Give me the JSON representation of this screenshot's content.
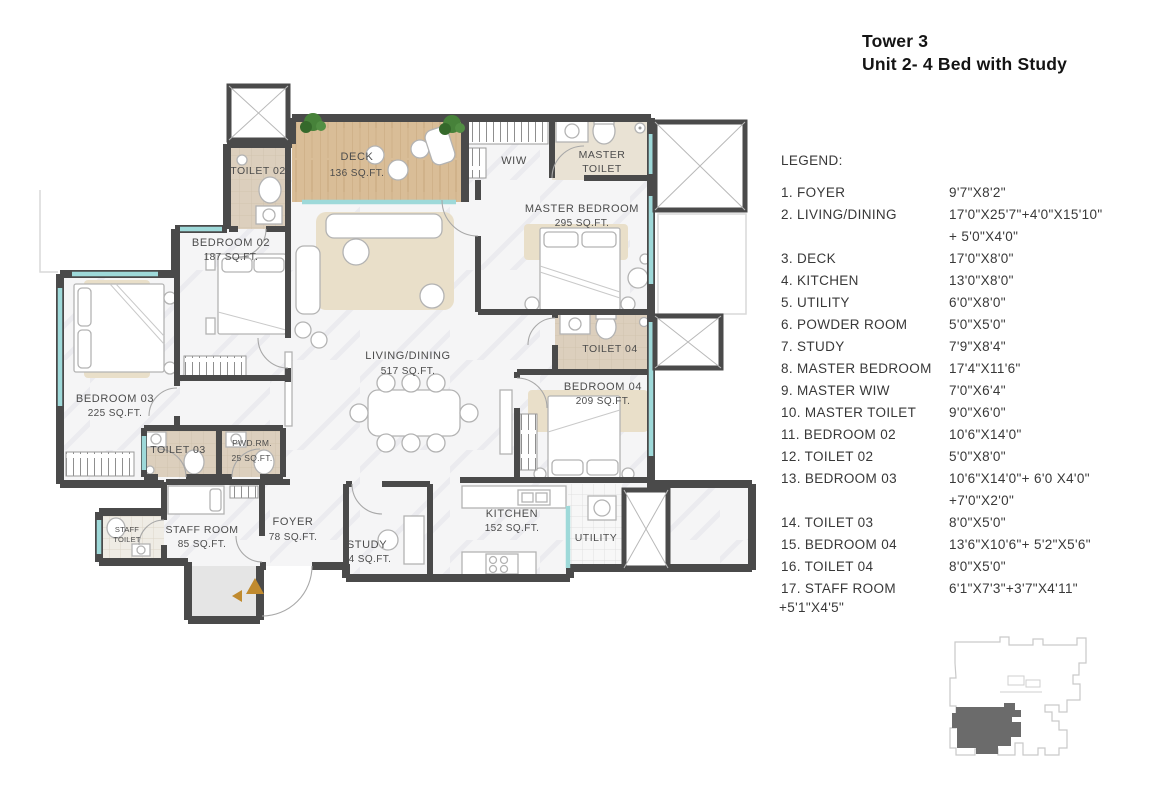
{
  "title": {
    "line1": "Tower 3",
    "line2": "Unit 2- 4 Bed with Study"
  },
  "legend": {
    "heading": "LEGEND:",
    "items": [
      {
        "label": "1. FOYER",
        "dim": "9'7\"X8'2\""
      },
      {
        "label": "2. LIVING/DINING",
        "dim": "17'0\"X25'7\"+4'0\"X15'10\"",
        "dim2": "+ 5'0\"X4'0\""
      },
      {
        "label": "3. DECK",
        "dim": "17'0\"X8'0\""
      },
      {
        "label": "4. KITCHEN",
        "dim": "13'0\"X8'0\""
      },
      {
        "label": "5. UTILITY",
        "dim": "6'0\"X8'0\""
      },
      {
        "label": "6. POWDER ROOM",
        "dim": "5'0\"X5'0\""
      },
      {
        "label": "7. STUDY",
        "dim": "7'9\"X8'4\""
      },
      {
        "label": "8. MASTER BEDROOM",
        "dim": "17'4\"X11'6\""
      },
      {
        "label": "9. MASTER WIW",
        "dim": "7'0\"X6'4\""
      },
      {
        "label": "10. MASTER TOILET",
        "dim": "9'0\"X6'0\""
      },
      {
        "label": "11. BEDROOM 02",
        "dim": "10'6\"X14'0\""
      },
      {
        "label": "12. TOILET 02",
        "dim": "5'0\"X8'0\""
      },
      {
        "label": "13. BEDROOM 03",
        "dim": "10'6\"X14'0\"+ 6'0 X4'0\"",
        "dim2": "+7'0\"X2'0\""
      },
      {
        "label": "14. TOILET 03",
        "dim": "8'0\"X5'0\""
      },
      {
        "label": "15. BEDROOM 04",
        "dim": "13'6\"X10'6\"+ 5'2\"X5'6\""
      },
      {
        "label": "16. TOILET 04",
        "dim": "8'0\"X5'0\""
      },
      {
        "label": "17. STAFF ROOM",
        "dim": "6'1\"X7'3\"+3'7\"X4'11\"",
        "label2": "+5'1\"X4'5\""
      }
    ]
  },
  "plan": {
    "rooms": {
      "toilet02": {
        "label": "TOILET 02"
      },
      "deck": {
        "label": "DECK",
        "area": "136 SQ.FT."
      },
      "wiw": {
        "label": "WIW"
      },
      "master_toilet": {
        "label": "MASTER",
        "label2": "TOILET"
      },
      "master_bedroom": {
        "label": "MASTER BEDROOM",
        "area": "295 SQ.FT."
      },
      "bedroom02": {
        "label": "BEDROOM 02",
        "area": "187 SQ.FT."
      },
      "bedroom03": {
        "label": "BEDROOM 03",
        "area": "225 SQ.FT."
      },
      "living_dining": {
        "label": "LIVING/DINING",
        "area": "517 SQ.FT."
      },
      "toilet04": {
        "label": "TOILET 04"
      },
      "bedroom04": {
        "label": "BEDROOM 04",
        "area": "209 SQ.FT."
      },
      "toilet03": {
        "label": "TOILET 03"
      },
      "powder_room": {
        "label": "PWD.RM.",
        "area": "25 SQ.FT."
      },
      "staff_toilet": {
        "label": "STAFF",
        "label2": "TOILET"
      },
      "staff_room": {
        "label": "STAFF ROOM",
        "area": "85 SQ.FT."
      },
      "foyer": {
        "label": "FOYER",
        "area": "78 SQ.FT."
      },
      "study": {
        "label": "STUDY",
        "area": "64 SQ.FT."
      },
      "kitchen": {
        "label": "KITCHEN",
        "area": "152 SQ.FT."
      },
      "utility": {
        "label": "UTILITY"
      }
    }
  },
  "colors": {
    "wall": "#4a4a4a",
    "window": "#9ed9d9",
    "deck_wood": "#d9bd97",
    "wet_floor": "#dccfbd",
    "rug": "#e9dfc9",
    "arrow": "#c08a2e",
    "plant": "#47823a",
    "unit_dark": "#6b6b6b"
  }
}
